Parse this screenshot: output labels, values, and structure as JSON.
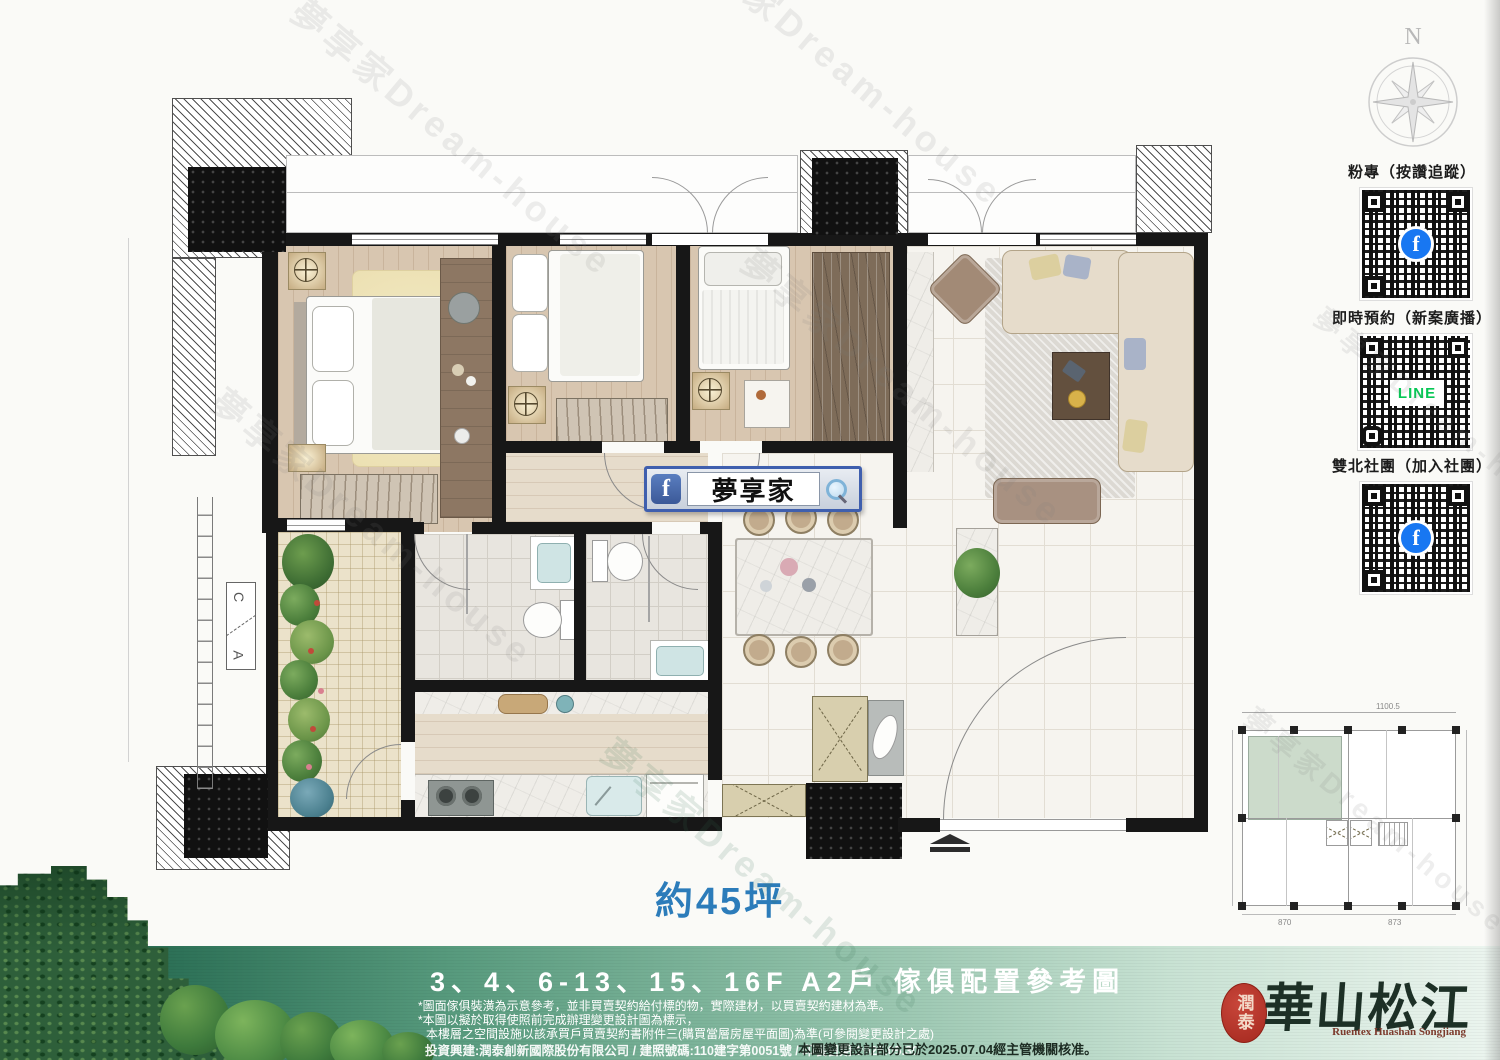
{
  "page": {
    "area_label": "約45坪"
  },
  "compass": {
    "north": "N"
  },
  "qr_panel": {
    "sections": [
      {
        "label": "粉專（按讚追蹤）",
        "icon": "facebook-icon",
        "icon_glyph": "f"
      },
      {
        "label": "即時預約（新案廣播）",
        "icon": "line-icon",
        "icon_text": "LINE"
      },
      {
        "label": "雙北社團（加入社團）",
        "icon": "facebook-icon",
        "icon_glyph": "f"
      }
    ]
  },
  "search_overlay": {
    "facebook_glyph": "f",
    "text": "夢享家"
  },
  "section_marker": {
    "top": "C",
    "bottom": "A"
  },
  "keyplan": {
    "dim_top_right": "1100.5",
    "dim_bottom_left": "870",
    "dim_bottom_right": "873"
  },
  "footer": {
    "floor_title": "3、4、6-13、15、16F A2戶 傢俱配置參考圖",
    "disclaimer_1": "*圖面傢俱裝潢為示意參考，並非買賣契約給付標的物，實際建材，以買賣契約建材為準。",
    "disclaimer_2": "*本圖以擬於取得使照前完成辦理變更設計圖為標示，",
    "disclaimer_3": "本樓層之空間設施以該承買戶買賣契約書附件三(購買當層房屋平面圖)為準(可參閱變更設計之處)",
    "company_line": "投資興建:潤泰創新國際股份有限公司 / 建照號碼:110建字第0051號 / 印製日期:2025.05.30",
    "approval_line": "本圖變更設計部分已於2025.07.04經主管機關核准。"
  },
  "brand": {
    "seal": "潤泰",
    "name": "華山松江",
    "romanized": "Ruentex Huashan Songjiang"
  },
  "watermark": {
    "text": "夢享家Dream-house"
  },
  "colors": {
    "area_label": "#2c7cba",
    "facebook": "#1877f2",
    "line": "#06c755",
    "seal_red": "#b5382e",
    "band_dark": "#1c5a40"
  }
}
